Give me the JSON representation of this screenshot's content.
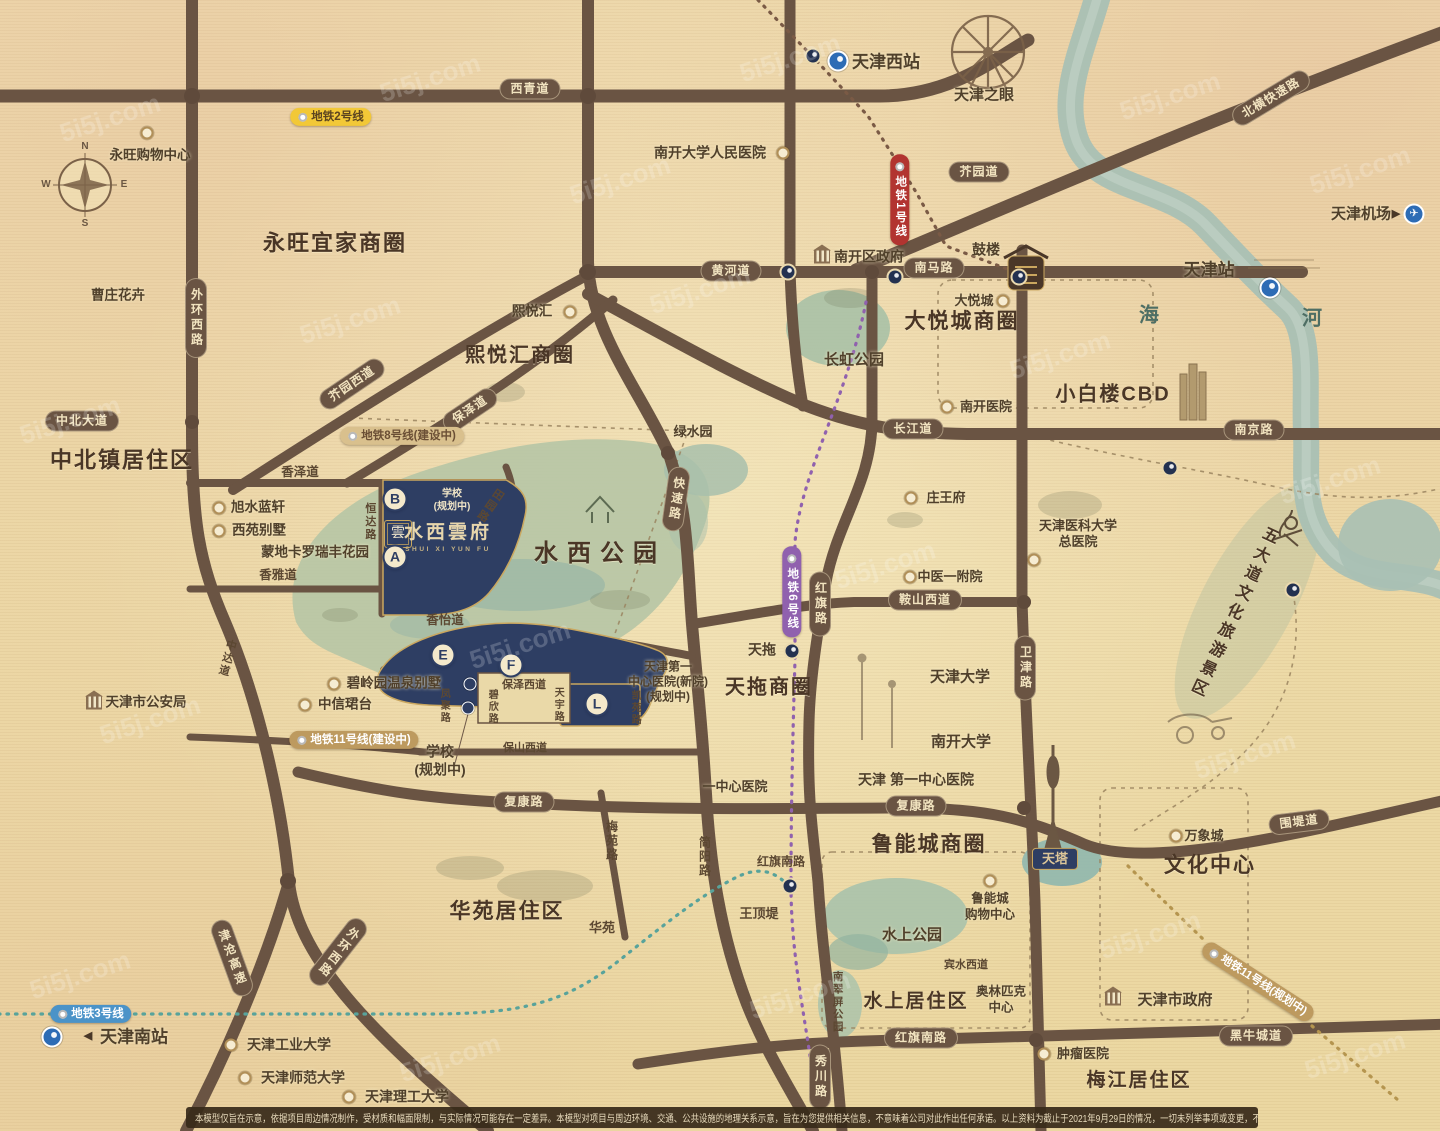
{
  "branding": {
    "seal": "雲",
    "name": "水西雲府",
    "latin": "SHUI XI YUN FU"
  },
  "disclaimer": "本模型仅旨在示意，依据项目周边情况制作，受材质和幅面限制，与实际情况可能存在一定差异。本模型对项目与周边环境、交通、公共设施的地理关系示意，旨在为您提供相关信息，不意味着公司对此作出任何承诺。以上资料为截止于2021年9月29日的情况，一切未列举事项或变更，不再另行通知。",
  "watermark_text": "5i5j.com",
  "watermarks": [
    [
      110,
      118
    ],
    [
      430,
      78
    ],
    [
      790,
      58
    ],
    [
      1170,
      96
    ],
    [
      1360,
      170
    ],
    [
      70,
      420
    ],
    [
      350,
      320
    ],
    [
      700,
      290
    ],
    [
      1060,
      355
    ],
    [
      1330,
      480
    ],
    [
      150,
      720
    ],
    [
      520,
      645
    ],
    [
      885,
      565
    ],
    [
      1245,
      755
    ],
    [
      80,
      975
    ],
    [
      450,
      1058
    ],
    [
      800,
      995
    ],
    [
      1150,
      935
    ],
    [
      1355,
      1055
    ],
    [
      620,
      180
    ]
  ],
  "elements": [
    {
      "n": "compass-label-n",
      "t": "lbl dim",
      "x": 85,
      "y": 147,
      "tx": "N",
      "fs": 10
    },
    {
      "n": "compass-label-w",
      "t": "lbl dim",
      "x": 46,
      "y": 185,
      "tx": "W",
      "fs": 10
    },
    {
      "n": "compass-label-e",
      "t": "lbl dim",
      "x": 124,
      "y": 185,
      "tx": "E",
      "fs": 10
    },
    {
      "n": "compass-label-s",
      "t": "lbl dim",
      "x": 85,
      "y": 224,
      "tx": "S",
      "fs": 10
    },
    {
      "n": "district-title-yongwang",
      "t": "ttl",
      "x": 335,
      "y": 243,
      "tx": "永旺宜家商圈",
      "fs": 22
    },
    {
      "n": "district-title-zhongbei",
      "t": "ttl",
      "x": 122,
      "y": 460,
      "tx": "中北镇居住区",
      "fs": 22
    },
    {
      "n": "district-title-xiyuehui",
      "t": "ttl",
      "x": 520,
      "y": 356,
      "tx": "熙悦汇商圈",
      "fs": 20
    },
    {
      "n": "district-title-dayuecheng",
      "t": "ttl",
      "x": 962,
      "y": 322,
      "tx": "大悦城商圈",
      "fs": 21
    },
    {
      "n": "park-title-shuixi",
      "t": "ttl sp",
      "x": 600,
      "y": 554,
      "tx": "水西公园",
      "fs": 24
    },
    {
      "n": "district-title-tiantuo",
      "t": "ttl",
      "x": 769,
      "y": 688,
      "tx": "天拖商圈",
      "fs": 20
    },
    {
      "n": "district-title-luneng",
      "t": "ttl",
      "x": 929,
      "y": 845,
      "tx": "鲁能城商圈",
      "fs": 21
    },
    {
      "n": "district-title-huayuan",
      "t": "ttl",
      "x": 507,
      "y": 912,
      "tx": "华苑居住区",
      "fs": 21
    },
    {
      "n": "district-title-wenhua",
      "t": "ttl",
      "x": 1210,
      "y": 866,
      "tx": "文化中心",
      "fs": 21
    },
    {
      "n": "district-title-shuishang",
      "t": "ttl",
      "x": 916,
      "y": 1002,
      "tx": "水上居住区",
      "fs": 19
    },
    {
      "n": "district-title-meijiang",
      "t": "ttl",
      "x": 1139,
      "y": 1081,
      "tx": "梅江居住区",
      "fs": 19
    },
    {
      "n": "district-title-xiaobailou",
      "t": "ttl",
      "x": 1113,
      "y": 395,
      "tx": "小白楼CBD",
      "fs": 20
    },
    {
      "n": "district-title-wudadao",
      "t": "ttl vert",
      "x": 1232,
      "y": 612,
      "tx": "五大道文化旅游景区",
      "fs": 16,
      "rot": 25
    },
    {
      "n": "road-badge-xiqingdao",
      "t": "rb",
      "x": 530,
      "y": 89,
      "tx": "西青道"
    },
    {
      "n": "road-badge-huanghedao",
      "t": "rb",
      "x": 731,
      "y": 271,
      "tx": "黄河道"
    },
    {
      "n": "road-badge-nanmalu",
      "t": "rb",
      "x": 934,
      "y": 268,
      "tx": "南马路"
    },
    {
      "n": "road-badge-jieyuandao",
      "t": "rb",
      "x": 979,
      "y": 172,
      "tx": "芥园道"
    },
    {
      "n": "road-badge-zhongbeidadao",
      "t": "rb",
      "x": 82,
      "y": 421,
      "tx": "中北大道"
    },
    {
      "n": "road-badge-changjiangdao",
      "t": "rb",
      "x": 913,
      "y": 429,
      "tx": "长江道"
    },
    {
      "n": "road-badge-nanjinglu",
      "t": "rb",
      "x": 1254,
      "y": 430,
      "tx": "南京路"
    },
    {
      "n": "road-badge-anshanxidao",
      "t": "rb",
      "x": 925,
      "y": 600,
      "tx": "鞍山西道"
    },
    {
      "n": "road-badge-fukanglu-west",
      "t": "rb",
      "x": 524,
      "y": 802,
      "tx": "复康路"
    },
    {
      "n": "road-badge-fukanglu-east",
      "t": "rb",
      "x": 916,
      "y": 806,
      "tx": "复康路"
    },
    {
      "n": "road-badge-weidadao",
      "t": "rb",
      "x": 1299,
      "y": 822,
      "tx": "围堤道",
      "rot": -7
    },
    {
      "n": "road-badge-heiniuchengdao",
      "t": "rb",
      "x": 1256,
      "y": 1036,
      "tx": "黑牛城道"
    },
    {
      "n": "road-badge-hongqinanlu",
      "t": "rb",
      "x": 921,
      "y": 1038,
      "tx": "红旗南路"
    },
    {
      "n": "road-badge-beiheng",
      "t": "rb",
      "x": 1271,
      "y": 98,
      "tx": "北横快速路",
      "rot": -31
    },
    {
      "n": "road-badge-jieyuanxidao",
      "t": "rb",
      "x": 352,
      "y": 384,
      "tx": "芥园西道",
      "rot": -34
    },
    {
      "n": "road-badge-baozedao",
      "t": "rb",
      "x": 470,
      "y": 410,
      "tx": "保泽道",
      "rot": -34
    },
    {
      "n": "road-badge-waihuanxilu-north",
      "t": "rb vert",
      "x": 196,
      "y": 318,
      "tx": "外环西路"
    },
    {
      "n": "road-badge-kuaisulu",
      "t": "rb vert",
      "x": 676,
      "y": 499,
      "tx": "快速路",
      "rot": 8
    },
    {
      "n": "road-badge-hongqilu",
      "t": "rb vert",
      "x": 820,
      "y": 604,
      "tx": "红旗路"
    },
    {
      "n": "road-badge-weijinlu",
      "t": "rb vert",
      "x": 1025,
      "y": 668,
      "tx": "卫津路"
    },
    {
      "n": "road-badge-xiuchuanlu",
      "t": "rb vert",
      "x": 820,
      "y": 1077,
      "tx": "秀川路"
    },
    {
      "n": "road-badge-jincang-expwy",
      "t": "rb vert",
      "x": 232,
      "y": 958,
      "tx": "津沧高速",
      "rot": -20
    },
    {
      "n": "road-badge-waihuanxilu-south",
      "t": "rb vert",
      "x": 338,
      "y": 952,
      "tx": "外环西路",
      "rot": 38
    },
    {
      "n": "metro-line2-badge",
      "t": "mb yellow",
      "x": 331,
      "y": 117,
      "tx": "地铁2号线"
    },
    {
      "n": "metro-line1-badge",
      "t": "mb red vert",
      "x": 900,
      "y": 200,
      "tx": "地铁1号线"
    },
    {
      "n": "metro-line8-badge",
      "t": "mb tan",
      "x": 402,
      "y": 436,
      "tx": "地铁8号线(建设中)"
    },
    {
      "n": "metro-line6-badge",
      "t": "mb purple vert",
      "x": 792,
      "y": 592,
      "tx": "地铁6号线"
    },
    {
      "n": "metro-line11-badge-construction",
      "t": "mb bronze",
      "x": 354,
      "y": 740,
      "tx": "地铁11号线(建设中)"
    },
    {
      "n": "metro-line3-badge",
      "t": "mb blue",
      "x": 91,
      "y": 1014,
      "tx": "地铁3号线"
    },
    {
      "n": "metro-line11-badge-planned",
      "t": "mb bronze",
      "x": 1258,
      "y": 982,
      "tx": "地铁11号线(规划中)",
      "rot": 33
    },
    {
      "n": "road-label-xiangzedao",
      "t": "lbl",
      "x": 300,
      "y": 473,
      "tx": "香泽道"
    },
    {
      "n": "road-label-xiangyadao",
      "t": "lbl",
      "x": 278,
      "y": 576,
      "tx": "香雅道"
    },
    {
      "n": "road-label-xiangyidao",
      "t": "lbl",
      "x": 445,
      "y": 621,
      "tx": "香怡道"
    },
    {
      "n": "road-label-hengdalu",
      "t": "lbl vert",
      "x": 369,
      "y": 522,
      "tx": "恒达路",
      "fs": 11
    },
    {
      "n": "road-label-tianyuanlu",
      "t": "lbl vert",
      "x": 489,
      "y": 505,
      "tx": "田园路",
      "fs": 11,
      "rot": 35
    },
    {
      "n": "road-label-zhongdadao",
      "t": "lbl vert",
      "x": 226,
      "y": 658,
      "tx": "中达道",
      "fs": 11,
      "rot": 15
    },
    {
      "n": "road-label-baozexidao",
      "t": "lbl",
      "x": 524,
      "y": 686,
      "tx": "保泽西道",
      "fs": 11
    },
    {
      "n": "road-label-bixinlu",
      "t": "lbl vert",
      "x": 491,
      "y": 707,
      "tx": "碧欣路",
      "fs": 10
    },
    {
      "n": "road-label-tianyulu",
      "t": "lbl vert",
      "x": 557,
      "y": 705,
      "tx": "天宇路",
      "fs": 10
    },
    {
      "n": "road-label-fengjulu",
      "t": "lbl vert",
      "x": 443,
      "y": 706,
      "tx": "凤聚路",
      "fs": 10
    },
    {
      "n": "road-label-baoshanxidao",
      "t": "lbl",
      "x": 525,
      "y": 749,
      "tx": "保山西道",
      "fs": 11
    },
    {
      "n": "road-label-meiyuanlu",
      "t": "lbl vert",
      "x": 611,
      "y": 841,
      "tx": "梅苑路",
      "fs": 12
    },
    {
      "n": "road-label-jianyanglu",
      "t": "lbl vert",
      "x": 704,
      "y": 857,
      "tx": "简阳路",
      "fs": 12
    },
    {
      "n": "park-label-nancuiping",
      "t": "lbl vert",
      "x": 837,
      "y": 1002,
      "tx": "南翠屏公园",
      "fs": 10.5
    },
    {
      "n": "road-label-binshuixidao",
      "t": "lbl",
      "x": 966,
      "y": 966,
      "tx": "宾水西道",
      "fs": 11
    },
    {
      "n": "road-label-kaiyuanlu",
      "t": "lbl vert",
      "x": 634,
      "y": 708,
      "tx": "凯苑路",
      "fs": 10
    },
    {
      "n": "road-label-hongqinanlu",
      "t": "lbl",
      "x": 781,
      "y": 862,
      "tx": "红旗南路",
      "fs": 12
    },
    {
      "n": "poi-label-huayuan",
      "t": "lbl",
      "x": 602,
      "y": 928,
      "tx": "华苑",
      "fs": 13
    },
    {
      "n": "poi-label-wangdingdi",
      "t": "lbl",
      "x": 759,
      "y": 914,
      "tx": "王顶堤",
      "fs": 13
    },
    {
      "n": "river-label-hai",
      "t": "lbl river",
      "x": 1150,
      "y": 316,
      "tx": "海",
      "fs": 20
    },
    {
      "n": "river-label-he",
      "t": "lbl river",
      "x": 1313,
      "y": 319,
      "tx": "河",
      "fs": 20
    },
    {
      "n": "poi-caozhuang-huahui",
      "t": "poi",
      "x": 118,
      "y": 296,
      "tx": "曹庄花卉"
    },
    {
      "n": "poi-yongwang-mall",
      "t": "poi",
      "x": 150,
      "y": 156,
      "tx": "永旺购物中心"
    },
    {
      "n": "poi-xiyuehui",
      "t": "poi",
      "x": 532,
      "y": 312,
      "tx": "熙悦汇"
    },
    {
      "n": "poi-xushui-lanxuan",
      "t": "poi",
      "x": 258,
      "y": 508,
      "tx": "旭水蓝轩"
    },
    {
      "n": "poi-xiyuan-villa",
      "t": "poi",
      "x": 259,
      "y": 531,
      "tx": "西苑别墅"
    },
    {
      "n": "poi-mengdikaluo",
      "t": "poi",
      "x": 315,
      "y": 553,
      "tx": "蒙地卡罗瑞丰花园"
    },
    {
      "n": "poi-bilingyuan-villa",
      "t": "poi",
      "x": 394,
      "y": 684,
      "tx": "碧岭园温泉别墅"
    },
    {
      "n": "poi-zhongxin-juntai",
      "t": "poi",
      "x": 345,
      "y": 705,
      "tx": "中信珺台"
    },
    {
      "n": "poi-public-security",
      "t": "poi",
      "x": 146,
      "y": 703,
      "tx": "天津市公安局"
    },
    {
      "n": "park-label-lvshuiyuan",
      "t": "poi",
      "x": 693,
      "y": 432,
      "tx": "绿水园",
      "fs": 13
    },
    {
      "n": "park-label-changhong",
      "t": "poi",
      "x": 854,
      "y": 361,
      "tx": "长虹公园",
      "fs": 15
    },
    {
      "n": "poi-dayuecheng",
      "t": "poi",
      "x": 974,
      "y": 301,
      "tx": "大悦城",
      "fs": 13
    },
    {
      "n": "poi-nankai-hospital",
      "t": "poi",
      "x": 986,
      "y": 407,
      "tx": "南开医院",
      "fs": 13
    },
    {
      "n": "poi-zhuangwangfu",
      "t": "poi",
      "x": 946,
      "y": 498,
      "tx": "庄王府",
      "fs": 13
    },
    {
      "n": "poi-zhongyi-hospital",
      "t": "poi",
      "x": 950,
      "y": 577,
      "tx": "中医一附院",
      "fs": 13
    },
    {
      "n": "poi-nankai-renmin-hospital",
      "t": "poi",
      "x": 710,
      "y": 153,
      "tx": "南开大学人民医院",
      "fs": 14
    },
    {
      "n": "poi-nankai-gov",
      "t": "poi",
      "x": 869,
      "y": 257,
      "tx": "南开区政府",
      "fs": 14
    },
    {
      "n": "poi-gulou",
      "t": "poi",
      "x": 986,
      "y": 250,
      "tx": "鼓楼",
      "fs": 14
    },
    {
      "n": "poi-tianjin-station",
      "t": "poi big",
      "x": 1209,
      "y": 270,
      "tx": "天津站",
      "fs": 17
    },
    {
      "n": "poi-tianjin-west-station",
      "t": "poi big",
      "x": 886,
      "y": 62,
      "tx": "天津西站",
      "fs": 17
    },
    {
      "n": "poi-tianjin-eye",
      "t": "poi big",
      "x": 984,
      "y": 96,
      "tx": "天津之眼",
      "fs": 15
    },
    {
      "n": "poi-tianjin-airport",
      "t": "poi big",
      "x": 1361,
      "y": 215,
      "tx": "天津机场",
      "fs": 15
    },
    {
      "n": "poi-tianjin-south-station",
      "t": "poi big",
      "x": 134,
      "y": 1037,
      "tx": "天津南站",
      "fs": 17
    },
    {
      "n": "poi-tianjin-university",
      "t": "poi big",
      "x": 960,
      "y": 678,
      "tx": "天津大学",
      "fs": 15
    },
    {
      "n": "poi-nankai-university",
      "t": "poi big",
      "x": 961,
      "y": 743,
      "tx": "南开大学",
      "fs": 15
    },
    {
      "n": "poi-first-central-hospital",
      "t": "poi",
      "x": 916,
      "y": 780,
      "tx": "天津 第一中心医院",
      "fs": 14
    },
    {
      "n": "poi-yizhongxin-hospital",
      "t": "poi",
      "x": 735,
      "y": 787,
      "tx": "一中心医院",
      "fs": 13
    },
    {
      "n": "poi-gongye-university",
      "t": "poi",
      "x": 289,
      "y": 1045,
      "tx": "天津工业大学",
      "fs": 14
    },
    {
      "n": "poi-shifan-university",
      "t": "poi",
      "x": 303,
      "y": 1078,
      "tx": "天津师范大学",
      "fs": 14
    },
    {
      "n": "poi-ligong-university",
      "t": "poi",
      "x": 407,
      "y": 1097,
      "tx": "天津理工大学",
      "fs": 14
    },
    {
      "n": "poi-city-gov",
      "t": "poi big",
      "x": 1175,
      "y": 1001,
      "tx": "天津市政府",
      "fs": 15
    },
    {
      "n": "poi-zhongliu-hospital",
      "t": "poi",
      "x": 1083,
      "y": 1054,
      "tx": "肿瘤医院",
      "fs": 13
    },
    {
      "n": "poi-wanxiangcheng",
      "t": "poi",
      "x": 1204,
      "y": 836,
      "tx": "万象城",
      "fs": 13
    },
    {
      "n": "park-label-shuishang",
      "t": "poi big",
      "x": 912,
      "y": 936,
      "tx": "水上公园",
      "fs": 15
    },
    {
      "n": "poi-luneng-mall",
      "t": "poi pre",
      "x": 990,
      "y": 907,
      "tx": "鲁能城\n购物中心",
      "fs": 12.5
    },
    {
      "n": "poi-olympic-center",
      "t": "poi pre",
      "x": 1001,
      "y": 1000,
      "tx": "奥林匹克\n中心",
      "fs": 12.5
    },
    {
      "n": "poi-tiantuo",
      "t": "poi big",
      "x": 762,
      "y": 650,
      "tx": "天拖",
      "fs": 14
    },
    {
      "n": "poi-yike-hospital",
      "t": "poi pre",
      "x": 1078,
      "y": 534,
      "tx": "天津医科大学\n总医院",
      "fs": 13
    },
    {
      "n": "poi-first-hospital-new",
      "t": "poi pre",
      "x": 668,
      "y": 682,
      "tx": "天津第一\n中心医院(新院)\n(规划中)",
      "fs": 12
    },
    {
      "n": "poi-school-planned",
      "t": "poi pre",
      "x": 440,
      "y": 761,
      "tx": "学校\n(规划中)",
      "fs": 14
    },
    {
      "n": "plot-school-label",
      "t": "poi pre cream",
      "x": 452,
      "y": 501,
      "tx": "学校\n(规划中)",
      "fs": 10
    },
    {
      "n": "poi-tianta",
      "t": "navlbl",
      "x": 1055,
      "y": 859,
      "tx": "天塔"
    },
    {
      "n": "plot-marker-a",
      "t": "plot",
      "x": 395,
      "y": 557,
      "tx": "A"
    },
    {
      "n": "plot-marker-b",
      "t": "plot",
      "x": 395,
      "y": 499,
      "tx": "B"
    },
    {
      "n": "plot-marker-e",
      "t": "plot",
      "x": 443,
      "y": 655,
      "tx": "E"
    },
    {
      "n": "plot-marker-f",
      "t": "plot",
      "x": 511,
      "y": 665,
      "tx": "F"
    },
    {
      "n": "plot-marker-l",
      "t": "plot",
      "x": 597,
      "y": 704,
      "tx": "L"
    },
    {
      "n": "station-junction-west-icon",
      "t": "st dark",
      "x": 813,
      "y": 56
    },
    {
      "n": "station-tianjinxi-metro-icon",
      "t": "st blue",
      "x": 838,
      "y": 61
    },
    {
      "n": "station-huanghedao-icon",
      "t": "st dark",
      "x": 788,
      "y": 272
    },
    {
      "n": "station-nanshi-icon",
      "t": "st dark",
      "x": 895,
      "y": 277
    },
    {
      "n": "station-gulou-east-icon",
      "t": "st dark",
      "x": 1019,
      "y": 277
    },
    {
      "n": "station-tianjinzhan-metro-icon",
      "t": "st blue",
      "x": 1270,
      "y": 288
    },
    {
      "n": "station-wudadao-north-icon",
      "t": "st dark",
      "x": 1170,
      "y": 468
    },
    {
      "n": "station-wudadao-east-icon",
      "t": "st dark",
      "x": 1293,
      "y": 590
    },
    {
      "n": "station-hongqinanlu-icon",
      "t": "st dark",
      "x": 790,
      "y": 886
    },
    {
      "n": "station-tiantuo-icon",
      "t": "st dark",
      "x": 792,
      "y": 651
    },
    {
      "n": "station-metro11-a-icon",
      "t": "st small",
      "x": 470,
      "y": 684
    },
    {
      "n": "station-metro11-b-icon",
      "t": "st small",
      "x": 468,
      "y": 708
    },
    {
      "n": "station-tianjinnan-metro-icon",
      "t": "st blue",
      "x": 52,
      "y": 1037
    },
    {
      "n": "airport-roundel-icon",
      "t": "st plane",
      "x": 1414,
      "y": 214,
      "tx": "✈"
    },
    {
      "n": "airport-arrow-icon",
      "t": "arrow",
      "x": 1396,
      "y": 215,
      "tx": "▶"
    },
    {
      "n": "south-station-arrow-icon",
      "t": "arrow",
      "x": 88,
      "y": 1037,
      "tx": "◀"
    },
    {
      "n": "yongwang-mall-icon",
      "t": "ic ring",
      "x": 147,
      "y": 133
    },
    {
      "n": "xiyuehui-icon",
      "t": "ic ring",
      "x": 570,
      "y": 312
    },
    {
      "n": "xushui-icon",
      "t": "ic ring",
      "x": 219,
      "y": 508
    },
    {
      "n": "xiyuan-icon",
      "t": "ic ring",
      "x": 219,
      "y": 531
    },
    {
      "n": "bilingyuan-icon",
      "t": "ic ring",
      "x": 334,
      "y": 684
    },
    {
      "n": "zhongxin-icon",
      "t": "ic ring",
      "x": 305,
      "y": 705
    },
    {
      "n": "dayuecheng-icon",
      "t": "ic ring",
      "x": 1003,
      "y": 301
    },
    {
      "n": "nankai-hospital-icon",
      "t": "ic ring",
      "x": 947,
      "y": 407
    },
    {
      "n": "zhuangwangfu-icon",
      "t": "ic ring",
      "x": 911,
      "y": 498
    },
    {
      "n": "zhongyi-icon",
      "t": "ic ring",
      "x": 910,
      "y": 577
    },
    {
      "n": "nankai-renmin-icon",
      "t": "ic ring",
      "x": 783,
      "y": 153
    },
    {
      "n": "gongye-univ-icon",
      "t": "ic ring",
      "x": 231,
      "y": 1045
    },
    {
      "n": "shifan-univ-icon",
      "t": "ic ring",
      "x": 245,
      "y": 1078
    },
    {
      "n": "ligong-univ-icon",
      "t": "ic ring",
      "x": 349,
      "y": 1097
    },
    {
      "n": "zhongliu-icon",
      "t": "ic ring",
      "x": 1044,
      "y": 1054
    },
    {
      "n": "wanxiangcheng-icon",
      "t": "ic ring",
      "x": 1176,
      "y": 836
    },
    {
      "n": "luneng-mall-icon",
      "t": "ic ring",
      "x": 990,
      "y": 881
    },
    {
      "n": "yike-hospital-icon",
      "t": "ic ring",
      "x": 1034,
      "y": 560
    },
    {
      "n": "gonganju-building-icon",
      "t": "ic bld",
      "x": 94,
      "y": 703
    },
    {
      "n": "nankaigov-building-icon",
      "t": "ic bld",
      "x": 822,
      "y": 257
    },
    {
      "n": "citygov-building-icon",
      "t": "ic bld",
      "x": 1113,
      "y": 999
    }
  ]
}
